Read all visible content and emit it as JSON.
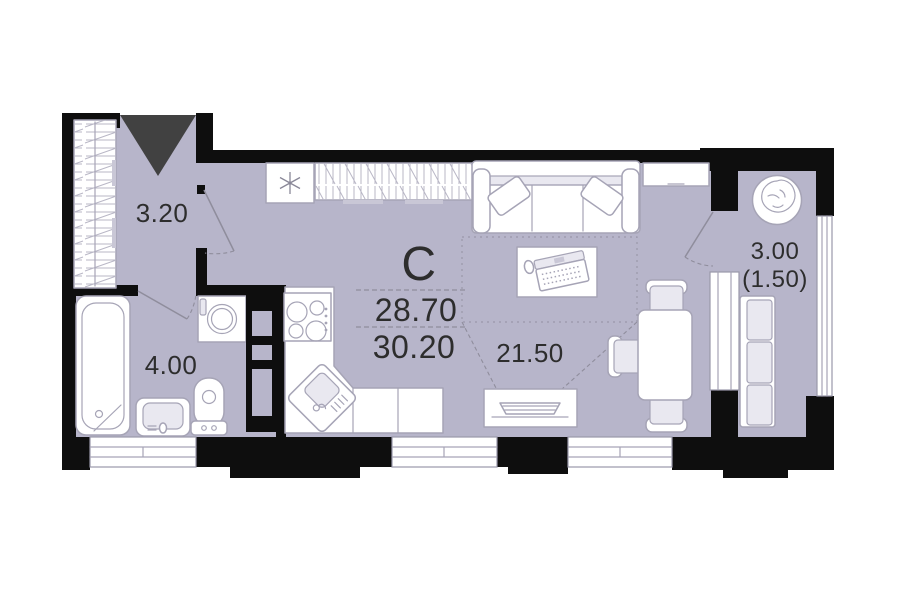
{
  "plan": {
    "labels": {
      "apartment_type": "С",
      "area_value_1": "28.70",
      "area_value_2": "30.20",
      "hallway_area": "3.20",
      "bathroom_area": "4.00",
      "living_area": "21.50",
      "balcony_area": "3.00",
      "balcony_area_reduced": "(1.50)"
    },
    "colors": {
      "floor": "#b7b5ca",
      "walls": "#0e0e0e",
      "furniture_outline": "#a6a4b6",
      "furniture_fill": "#ffffff",
      "soft_fill": "#e9e8f0",
      "entrance_marker": "#414141",
      "label_text": "#2d2d2d",
      "background": "#ffffff"
    },
    "icons": [
      "entrance-arrow-icon",
      "wardrobe-icon",
      "closet-icon",
      "fridge-icon",
      "snowflake-icon",
      "sofa-icon",
      "pillow-icon",
      "desk-icon",
      "laptop-icon",
      "mouse-icon",
      "rug-outline-icon",
      "tv-icon",
      "dining-table-icon",
      "chair-icon",
      "kitchen-counter-icon",
      "stove-icon",
      "kitchen-sink-icon",
      "washing-machine-icon",
      "shelf-rack-icon",
      "bathtub-icon",
      "washbasin-icon",
      "toilet-icon",
      "balcony-bench-icon",
      "plant-icon",
      "door-swing-icon",
      "window-icon"
    ]
  }
}
